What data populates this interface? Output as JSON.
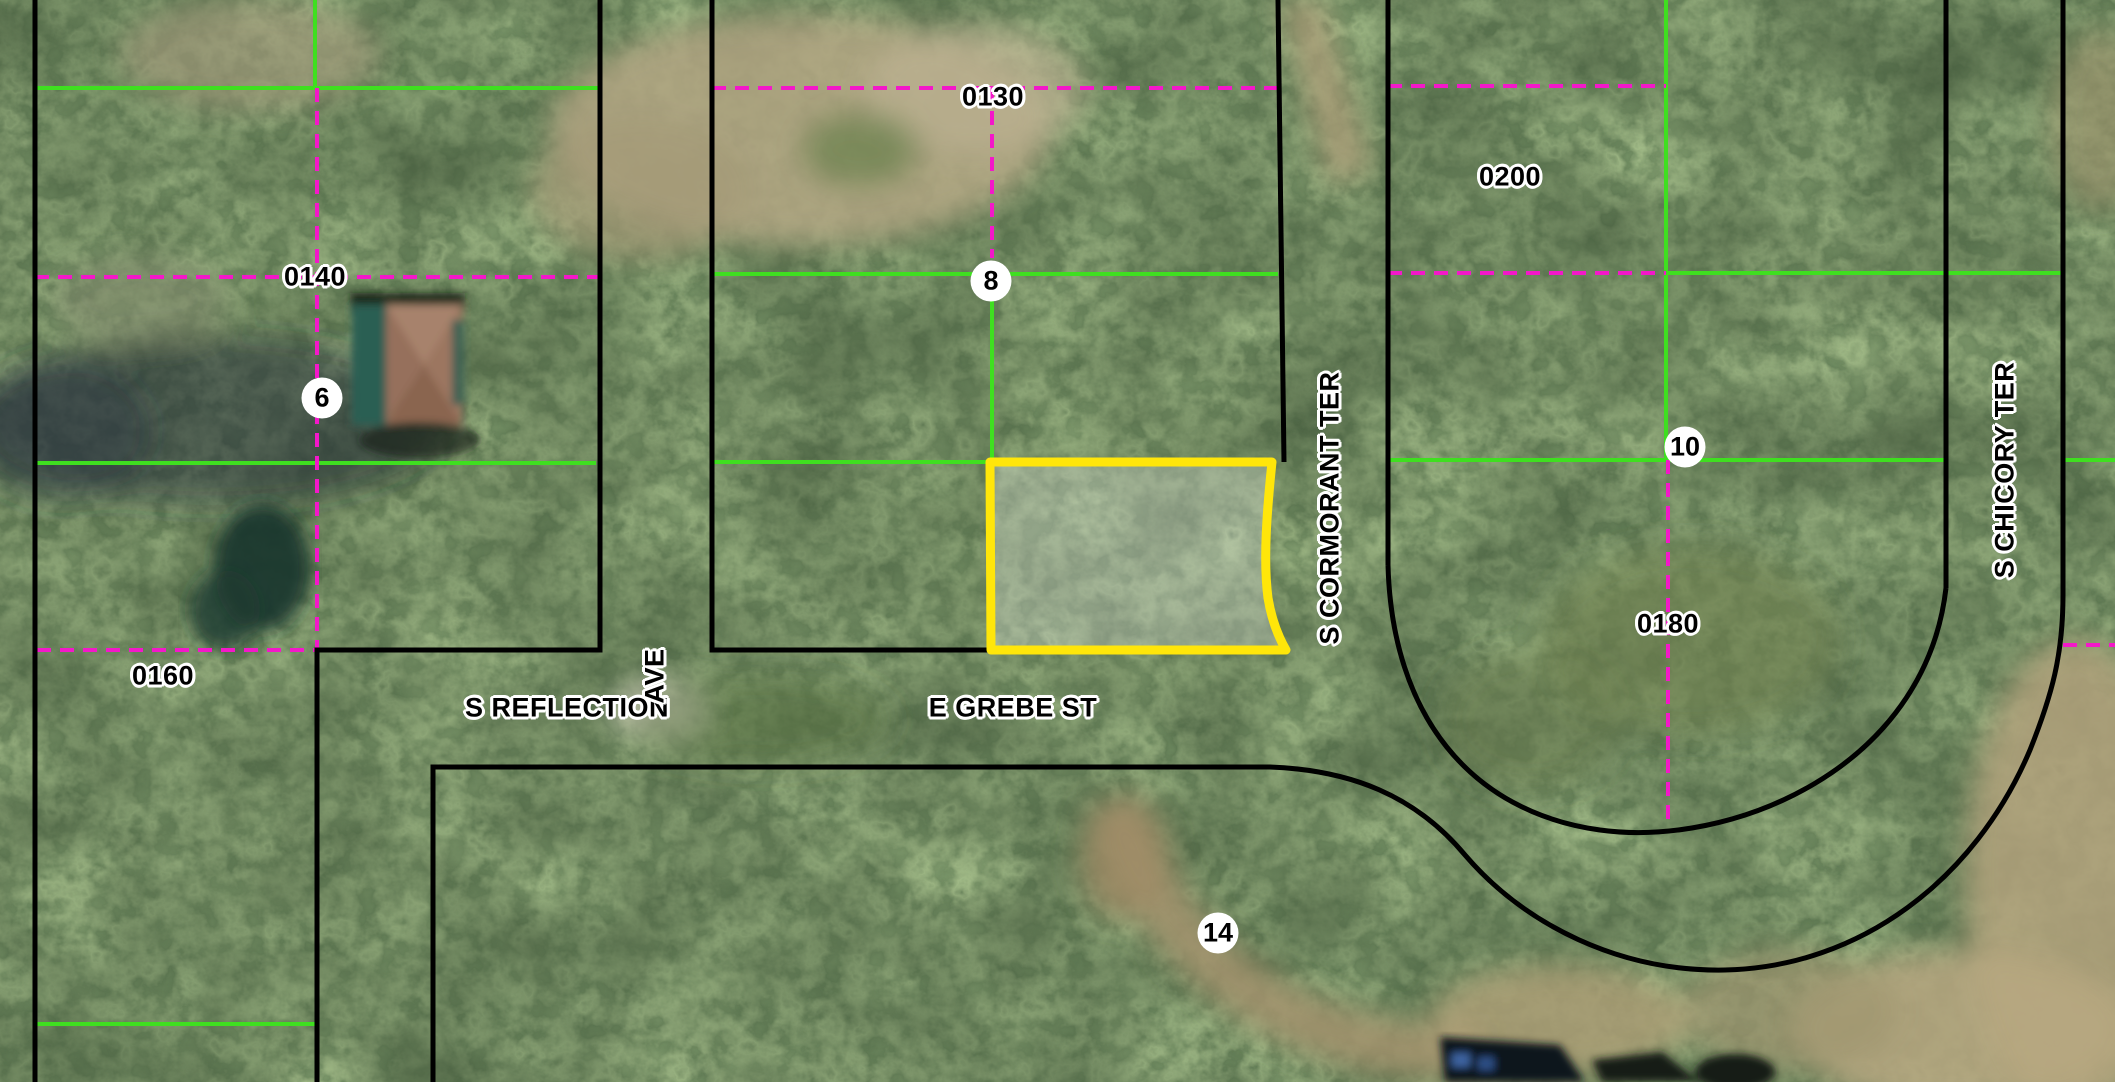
{
  "map": {
    "description": "Aerial parcel map with a yellow highlighted lot",
    "highlighted_parcel": {
      "outline_color": "#ffe60a",
      "fill": "rgba(255,255,255,0.28)",
      "location": "north side of E Grebe St, west of S Cormorant Ter"
    },
    "parcel_labels": [
      {
        "id": "0140",
        "x": 315,
        "y": 277
      },
      {
        "id": "0130",
        "x": 993,
        "y": 97
      },
      {
        "id": "0160",
        "x": 163,
        "y": 676
      },
      {
        "id": "0200",
        "x": 1510,
        "y": 177
      },
      {
        "id": "0180",
        "x": 1668,
        "y": 624
      }
    ],
    "lot_numbers": [
      {
        "n": "6",
        "x": 322,
        "y": 398
      },
      {
        "n": "8",
        "x": 991,
        "y": 281
      },
      {
        "n": "10",
        "x": 1685,
        "y": 447
      },
      {
        "n": "14",
        "x": 1218,
        "y": 933
      }
    ],
    "streets": [
      {
        "name": "S REFLECTION",
        "x": 567,
        "y": 708,
        "orientation": "horizontal"
      },
      {
        "name": "AVE",
        "x": 655,
        "y": 676,
        "orientation": "vertical"
      },
      {
        "name": "E GREBE ST",
        "x": 1013,
        "y": 708,
        "orientation": "horizontal"
      },
      {
        "name": "S CORMORANT TER",
        "x": 1330,
        "y": 508,
        "orientation": "vertical"
      },
      {
        "name": "S CHICORY TER",
        "x": 2005,
        "y": 470,
        "orientation": "vertical"
      }
    ],
    "line_colors": {
      "block_boundary": "#000000",
      "lot_line_solid": "#3fdf20",
      "lot_line_dashed": "#f318c9",
      "highlight": "#ffe60a"
    }
  }
}
